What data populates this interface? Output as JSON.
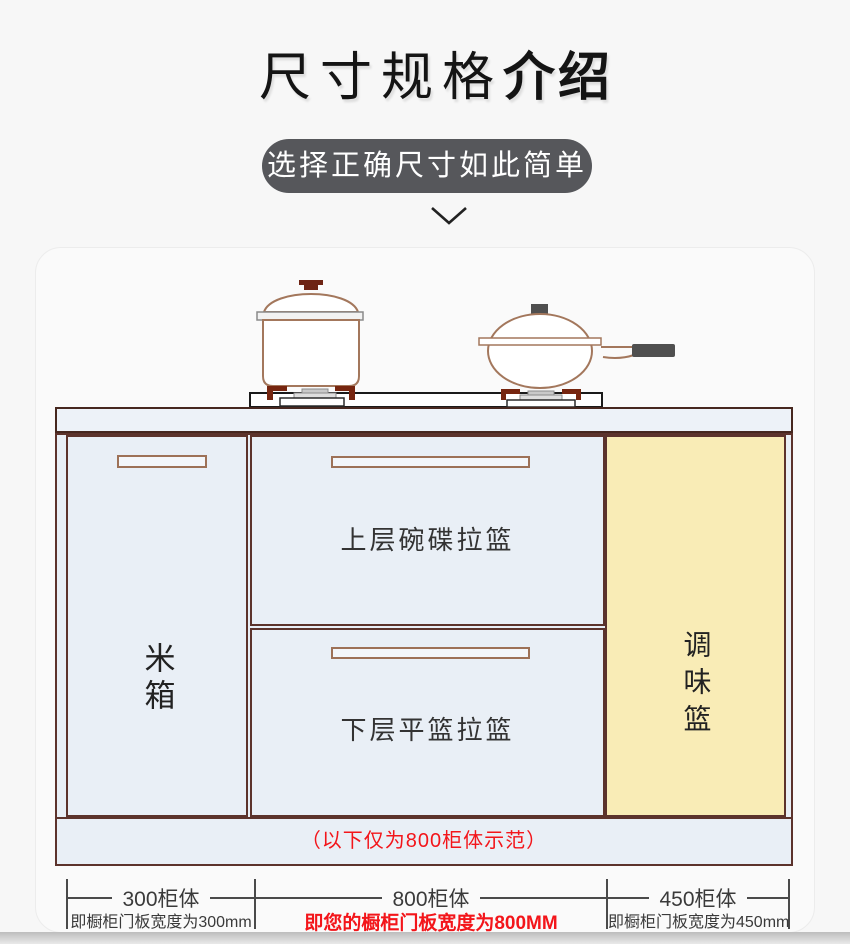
{
  "header": {
    "title_regular": "尺寸规格",
    "title_bold": "介绍",
    "subtitle": "选择正确尺寸如此简单"
  },
  "cabinet": {
    "left_door_label": "米箱",
    "top_drawer_label": "上层碗碟拉篮",
    "bottom_drawer_label": "下层平篮拉篮",
    "right_panel_label": "调味篮",
    "plinth_note": "（以下仅为800柜体示范）"
  },
  "dimensions": [
    {
      "label": "300柜体",
      "sublabel": "即橱柜门板宽度为300mm",
      "highlight": false
    },
    {
      "label": "800柜体",
      "sublabel": "即您的橱柜门板宽度为800MM",
      "highlight": true
    },
    {
      "label": "450柜体",
      "sublabel": "即橱柜门板宽度为450mm",
      "highlight": false
    }
  ],
  "icons": {
    "chevron": "chevron-down-icon",
    "pot": "stock-pot-icon",
    "wok": "wok-icon",
    "burner": "gas-burner-icon"
  },
  "colors": {
    "accent_red": "#f3151a",
    "cabinet_fill": "#e9eff6",
    "spice_panel_fill": "#f9ecb6",
    "frame_border": "#5c332c",
    "pill_background": "#56575b",
    "cookware_outline": "#a3775c"
  }
}
